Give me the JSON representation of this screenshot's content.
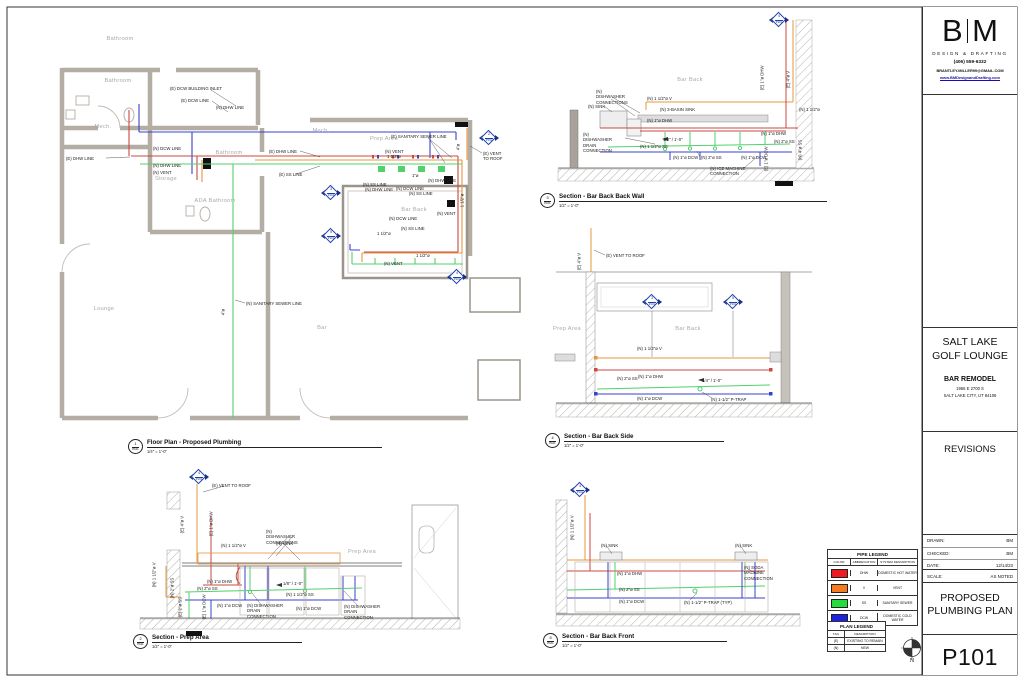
{
  "title_block": {
    "logo_b": "B",
    "logo_m": "M",
    "firm": "DESIGN & DRAFTING",
    "phone": "(406) 559-6332",
    "email": "BRANTLEY.MILLER99@GMAIL.COM",
    "website": "www.BMDesignandDrafting.com",
    "project_name_line1": "SALT LAKE",
    "project_name_line2": "GOLF LOUNGE",
    "project_type": "BAR REMODEL",
    "address_line1": "1956 E 2700 S",
    "address_line2": "SALT LAKE CITY, UT 84106",
    "revisions_label": "REVISIONS",
    "drawn_label": "DRAWN:",
    "drawn_value": "BM",
    "checked_label": "CHECKED:",
    "checked_value": "BM",
    "date_label": "DATE:",
    "date_value": "12/14/23",
    "scale_label": "SCALE:",
    "scale_value": "AS NOTED",
    "sheet_title_line1": "PROPOSED",
    "sheet_title_line2": "PLUMBING PLAN",
    "sheet_number": "P101"
  },
  "colors": {
    "dhw": "#ed1c24",
    "vent": "#f57b20",
    "ss": "#22dd3c",
    "dcw": "#1f23dd",
    "marker": "#1c3fae"
  },
  "pipe_legend": {
    "title": "PIPE LEGEND",
    "headers": [
      "COLOR",
      "ABBREVIATION",
      "SYSTEM DESCRIPTION"
    ],
    "rows": [
      {
        "color": "#ed1c24",
        "abbr": "DHW",
        "desc": "DOMESTIC HOT WATER"
      },
      {
        "color": "#f57b20",
        "abbr": "V",
        "desc": "VENT"
      },
      {
        "color": "#22dd3c",
        "abbr": "SS",
        "desc": "SANITARY SEWER"
      },
      {
        "color": "#1f23dd",
        "abbr": "DCW",
        "desc": "DOMESTIC COLD WATER"
      }
    ]
  },
  "plan_legend": {
    "title": "PLAN LEGEND",
    "headers": [
      "TAG",
      "DESCRIPTION"
    ],
    "rows": [
      {
        "tag": "(E)",
        "desc": "EXISTING TO REMAIN"
      },
      {
        "tag": "(N)",
        "desc": "NEW"
      }
    ]
  },
  "north_label": "N",
  "viewports": [
    {
      "num": "1",
      "sheet": "P101",
      "title": "Floor Plan - Proposed Plumbing",
      "scale": "1/4\" = 1'-0\"",
      "x": 128,
      "y": 439,
      "lw": 235
    },
    {
      "num": "2",
      "sheet": "P101",
      "title": "Section - Prep Area",
      "scale": "1/2\" = 1'-0\"",
      "x": 133,
      "y": 634,
      "lw": 150
    },
    {
      "num": "3",
      "sheet": "P101",
      "title": "Section - Bar Back Back Wall",
      "scale": "1/2\" = 1'-0\"",
      "x": 540,
      "y": 193,
      "lw": 268
    },
    {
      "num": "4",
      "sheet": "P101",
      "title": "Section - Bar Back Side",
      "scale": "1/2\" = 1'-0\"",
      "x": 545,
      "y": 433,
      "lw": 160
    },
    {
      "num": "5",
      "sheet": "P101",
      "title": "Section - Bar Back Front",
      "scale": "1/2\" = 1'-0\"",
      "x": 543,
      "y": 633,
      "lw": 165
    }
  ],
  "section_markers": [
    {
      "num": "3",
      "sheet": "P101",
      "x": 331,
      "y": 193
    },
    {
      "num": "5",
      "sheet": "P101",
      "x": 331,
      "y": 236
    },
    {
      "num": "2",
      "sheet": "P101",
      "x": 489,
      "y": 138
    },
    {
      "num": "4",
      "sheet": "P101",
      "x": 457,
      "y": 277
    },
    {
      "num": "4",
      "sheet": "P101",
      "x": 779,
      "y": 20
    },
    {
      "num": "3",
      "sheet": "P101",
      "x": 652,
      "y": 302
    },
    {
      "num": "5",
      "sheet": "P101",
      "x": 733,
      "y": 302
    },
    {
      "num": "4",
      "sheet": "P101",
      "x": 199,
      "y": 477
    },
    {
      "num": "4",
      "sheet": "P101",
      "x": 580,
      "y": 490
    }
  ],
  "annotations": [
    {
      "t": "Bathroom",
      "x": 120,
      "y": 36,
      "c": "r"
    },
    {
      "t": "Bathroom",
      "x": 118,
      "y": 78,
      "c": "r"
    },
    {
      "t": "Mech.",
      "x": 103,
      "y": 124,
      "c": "r"
    },
    {
      "t": "Storage",
      "x": 166,
      "y": 176,
      "c": "r"
    },
    {
      "t": "Lounge",
      "x": 104,
      "y": 306,
      "c": "r"
    },
    {
      "t": "Mech.",
      "x": 321,
      "y": 128,
      "c": "r"
    },
    {
      "t": "Prep Area",
      "x": 384,
      "y": 136,
      "c": "r"
    },
    {
      "t": "ADA Bathroom",
      "x": 215,
      "y": 198,
      "c": "r"
    },
    {
      "t": "Bathroom",
      "x": 229,
      "y": 150,
      "c": "r"
    },
    {
      "t": "Bar Back",
      "x": 414,
      "y": 207,
      "c": "r"
    },
    {
      "t": "Bar",
      "x": 322,
      "y": 325,
      "c": "r"
    },
    {
      "t": "(E) DCW BUILDING INLET",
      "x": 170,
      "y": 86,
      "c": "n"
    },
    {
      "t": "(E) DCW LINE",
      "x": 181,
      "y": 98,
      "c": "n"
    },
    {
      "t": "(N) DHW LINE",
      "x": 216,
      "y": 105,
      "c": "n"
    },
    {
      "t": "(E) DHW LINE",
      "x": 66,
      "y": 156,
      "c": "n"
    },
    {
      "t": "(N) DCW LINE",
      "x": 153,
      "y": 146,
      "c": "n"
    },
    {
      "t": "(N) DHW LINE",
      "x": 153,
      "y": 163,
      "c": "n"
    },
    {
      "t": "(N) VENT",
      "x": 153,
      "y": 170,
      "c": "n"
    },
    {
      "t": "(E) DHW LINE",
      "x": 269,
      "y": 149,
      "c": "n"
    },
    {
      "t": "(E) SS LINE",
      "x": 279,
      "y": 172,
      "c": "n"
    },
    {
      "t": "(E) SANITARY SEWER LINE",
      "x": 391,
      "y": 134,
      "c": "n"
    },
    {
      "t": "(N) VENT",
      "x": 385,
      "y": 149,
      "c": "n"
    },
    {
      "t": "1 1/2\"ø",
      "x": 387,
      "y": 154,
      "c": "n"
    },
    {
      "t": "(N) SS LINE",
      "x": 363,
      "y": 182,
      "c": "n"
    },
    {
      "t": "(N) DHW LINE",
      "x": 365,
      "y": 187,
      "c": "n"
    },
    {
      "t": "(N) DCW LINE",
      "x": 396,
      "y": 186,
      "c": "n"
    },
    {
      "t": "(N) SS LINE",
      "x": 409,
      "y": 191,
      "c": "n"
    },
    {
      "t": "1\"ø",
      "x": 412,
      "y": 173,
      "c": "n"
    },
    {
      "t": "(N) DHW LINE",
      "x": 428,
      "y": 178,
      "c": "n"
    },
    {
      "t": "(N) VENT",
      "x": 437,
      "y": 211,
      "c": "n"
    },
    {
      "t": "(N) DCW LINE",
      "x": 389,
      "y": 216,
      "c": "n"
    },
    {
      "t": "(N) SS LINE",
      "x": 401,
      "y": 226,
      "c": "n"
    },
    {
      "t": "1 1/2\"ø",
      "x": 377,
      "y": 231,
      "c": "n"
    },
    {
      "t": "1 1/2\"ø",
      "x": 416,
      "y": 253,
      "c": "n"
    },
    {
      "t": "(N) VENT",
      "x": 384,
      "y": 261,
      "c": "n"
    },
    {
      "t": "(N) SANITARY SEWER LINE",
      "x": 246,
      "y": 301,
      "c": "n"
    },
    {
      "t": "4\"ø",
      "x": 226,
      "y": 315,
      "c": "v"
    },
    {
      "t": "(E) VENT",
      "x": 483,
      "y": 151,
      "c": "n"
    },
    {
      "t": "TO ROOF",
      "x": 483,
      "y": 156,
      "c": "n"
    },
    {
      "t": "4\"ø",
      "x": 461,
      "y": 150,
      "c": "v"
    },
    {
      "t": "1 1/2\"ø",
      "x": 465,
      "y": 207,
      "c": "v"
    },
    {
      "t": "Bar Back",
      "x": 690,
      "y": 77,
      "c": "r"
    },
    {
      "t": "(N) DISHWASHER CONNECTIONS",
      "x": 596,
      "y": 89,
      "c": "n",
      "w": 36
    },
    {
      "t": "(N) SINK",
      "x": 588,
      "y": 104,
      "c": "n"
    },
    {
      "t": "(N) 1 1/2\"ø V",
      "x": 647,
      "y": 96,
      "c": "n"
    },
    {
      "t": "(N) 3-BASIN SINK",
      "x": 660,
      "y": 107,
      "c": "n"
    },
    {
      "t": "(N) 1\"ø DHW",
      "x": 647,
      "y": 118,
      "c": "n"
    },
    {
      "t": "(N) DISHWASHER DRAIN CONNECTION",
      "x": 583,
      "y": 132,
      "c": "n",
      "w": 36
    },
    {
      "t": "1/8\" / 1'-0\"",
      "x": 663,
      "y": 137,
      "c": "n"
    },
    {
      "t": "(N) 1 1/2\"ø SS",
      "x": 640,
      "y": 144,
      "c": "n"
    },
    {
      "t": "(N) 1\"ø DCW",
      "x": 673,
      "y": 155,
      "c": "n"
    },
    {
      "t": "(N) 2\"ø SS",
      "x": 701,
      "y": 155,
      "c": "n"
    },
    {
      "t": "(N) 1\"ø DCW",
      "x": 741,
      "y": 155,
      "c": "n"
    },
    {
      "t": "(N) ICE MACHINE CONNECTION",
      "x": 710,
      "y": 166,
      "c": "n",
      "w": 40
    },
    {
      "t": "(N) 1\"ø DHW",
      "x": 761,
      "y": 131,
      "c": "n"
    },
    {
      "t": "(N) 2\"ø SS",
      "x": 774,
      "y": 139,
      "c": "n"
    },
    {
      "t": "(N) 1 1/2\"ø",
      "x": 799,
      "y": 107,
      "c": "n"
    },
    {
      "t": "(E) 1\"ø DHW",
      "x": 765,
      "y": 90,
      "c": "v"
    },
    {
      "t": "(E) 4\"ø V",
      "x": 791,
      "y": 88,
      "c": "v"
    },
    {
      "t": "(N) 4\"ø SS",
      "x": 803,
      "y": 160,
      "c": "v"
    },
    {
      "t": "(E) 1\"ø DCW",
      "x": 769,
      "y": 171,
      "c": "v"
    },
    {
      "t": "(E) VENT TO ROOF",
      "x": 606,
      "y": 253,
      "c": "n"
    },
    {
      "t": "(E) 4\"ø V",
      "x": 582,
      "y": 270,
      "c": "v"
    },
    {
      "t": "Prep Area",
      "x": 567,
      "y": 326,
      "c": "r"
    },
    {
      "t": "Bar Back",
      "x": 688,
      "y": 326,
      "c": "r"
    },
    {
      "t": "(N) 1 1/2\"ø V",
      "x": 637,
      "y": 346,
      "c": "n"
    },
    {
      "t": "(N) 1\"ø DHW",
      "x": 638,
      "y": 374,
      "c": "n"
    },
    {
      "t": "(N) 2\"ø SS",
      "x": 617,
      "y": 376,
      "c": "n"
    },
    {
      "t": "1/4\" / 1'-0\"",
      "x": 702,
      "y": 378,
      "c": "n"
    },
    {
      "t": "(N) 1\"ø DCW",
      "x": 637,
      "y": 396,
      "c": "n"
    },
    {
      "t": "(N) 1-1/2\" P-TRAP",
      "x": 711,
      "y": 397,
      "c": "n"
    },
    {
      "t": "(E) VENT TO ROOF",
      "x": 212,
      "y": 483,
      "c": "n"
    },
    {
      "t": "(E) 4\"ø V",
      "x": 185,
      "y": 533,
      "c": "v"
    },
    {
      "t": "(E) 1\"ø DHW",
      "x": 214,
      "y": 536,
      "c": "v"
    },
    {
      "t": "(N) 1 1/2\"ø V",
      "x": 221,
      "y": 543,
      "c": "n"
    },
    {
      "t": "(N) DISHWASHER CONNECTIONS",
      "x": 266,
      "y": 529,
      "c": "n",
      "w": 36
    },
    {
      "t": "(N) SINK",
      "x": 276,
      "y": 541,
      "c": "n"
    },
    {
      "t": "Prep Area",
      "x": 362,
      "y": 549,
      "c": "r"
    },
    {
      "t": "(N) 1 1/2\"ø V",
      "x": 157,
      "y": 587,
      "c": "v"
    },
    {
      "t": "(N) 1\"ø DHW",
      "x": 207,
      "y": 579,
      "c": "n"
    },
    {
      "t": "(N) 2\"ø SS",
      "x": 197,
      "y": 586,
      "c": "n"
    },
    {
      "t": "(N) 2\"ø SS",
      "x": 175,
      "y": 598,
      "c": "v"
    },
    {
      "t": "1/8\" / 1'-0\"",
      "x": 283,
      "y": 581,
      "c": "n"
    },
    {
      "t": "(N) 1 1/2\"ø SS",
      "x": 286,
      "y": 592,
      "c": "n"
    },
    {
      "t": "(N) 1\"ø DCW",
      "x": 217,
      "y": 603,
      "c": "n"
    },
    {
      "t": "(N) DISHWASHER DRAIN CONNECTION",
      "x": 247,
      "y": 603,
      "c": "n",
      "w": 40
    },
    {
      "t": "(N) 1\"ø DCW",
      "x": 296,
      "y": 606,
      "c": "n"
    },
    {
      "t": "(N) DISHWASHER DRAIN CONNECTION",
      "x": 344,
      "y": 604,
      "c": "n",
      "w": 40
    },
    {
      "t": "(E) 2\"ø SS",
      "x": 183,
      "y": 617,
      "c": "v"
    },
    {
      "t": "(E) 1\"ø DCW",
      "x": 207,
      "y": 619,
      "c": "v"
    },
    {
      "t": "(N) SINK",
      "x": 601,
      "y": 543,
      "c": "n"
    },
    {
      "t": "(N) SINK",
      "x": 735,
      "y": 543,
      "c": "n"
    },
    {
      "t": "(N) SODA MACHINE CONNECTION",
      "x": 744,
      "y": 565,
      "c": "n",
      "w": 36
    },
    {
      "t": "(N) 1-1/2\" P-TRAP (TYP)",
      "x": 684,
      "y": 600,
      "c": "n"
    },
    {
      "t": "(N) 1\"ø DHW",
      "x": 617,
      "y": 571,
      "c": "n"
    },
    {
      "t": "(N) 2\"ø SS",
      "x": 619,
      "y": 587,
      "c": "n"
    },
    {
      "t": "(N) 1\"ø DCW",
      "x": 619,
      "y": 599,
      "c": "n"
    },
    {
      "t": "(N) 1 1/2\"ø V",
      "x": 575,
      "y": 540,
      "c": "v"
    }
  ]
}
